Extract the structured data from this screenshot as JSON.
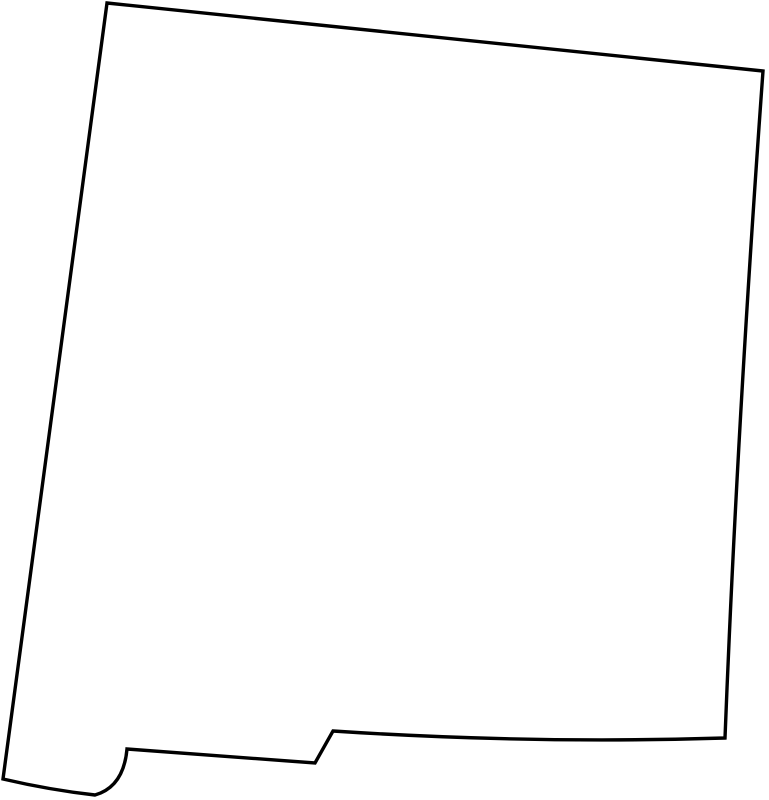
{
  "page": {
    "background_color": "#ffffff"
  },
  "map": {
    "subject": "new-mexico-state-outline",
    "kind": "blank-outline-map",
    "stroke_color": "#000000",
    "fill_color": "#ffffff",
    "stroke_width": "3.4",
    "viewbox": "0 0 769 800",
    "outline_path": "M 107,3 L 763,71 Q 737,430 725,738 Q 530,744 333,731 L 315,763 L 127,749 C 125,771 116,789 95,795 Q 50,790 3,779 Z",
    "features": {
      "top_left_corner": [
        107,
        3
      ],
      "top_right_corner": [
        763,
        71
      ],
      "bottom_right_corner": [
        725,
        738
      ],
      "southern_step_top": [
        333,
        731
      ],
      "southern_step_bottom": [
        315,
        763
      ],
      "bootheel_curve_start": [
        127,
        749
      ],
      "bootheel_lowest_point": [
        95,
        795
      ],
      "bottom_left_corner": [
        3,
        779
      ]
    }
  }
}
